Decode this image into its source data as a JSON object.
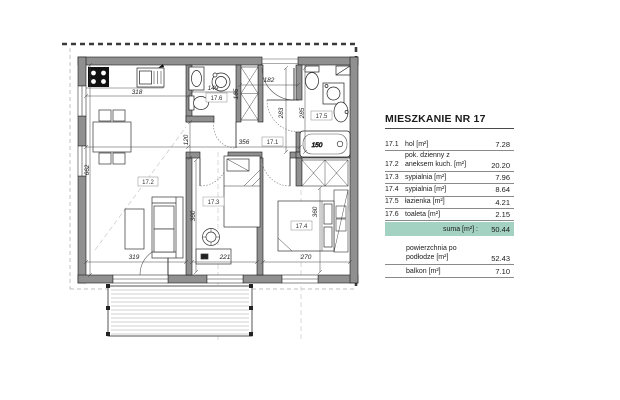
{
  "title": "MIESZKANIE NR 17",
  "area_table": {
    "rows": [
      {
        "code": "17.1",
        "name": "hol [m²]",
        "value": "7.28"
      },
      {
        "code": "17.2",
        "name": "pok. dzienny z aneksem kuch. [m²]",
        "value": "20.20"
      },
      {
        "code": "17.3",
        "name": "sypialnia [m²]",
        "value": "7.96"
      },
      {
        "code": "17.4",
        "name": "sypialnia [m²]",
        "value": "8.64"
      },
      {
        "code": "17.5",
        "name": "łazienka [m²]",
        "value": "4.21"
      },
      {
        "code": "17.6",
        "name": "toaleta [m²]",
        "value": "2.15"
      }
    ],
    "sum_label": "suma [m²] :",
    "sum_value": "50.44",
    "extra_rows": [
      {
        "name": "powierzchnia po podłodze [m²]",
        "value": "52.43"
      },
      {
        "name": "balkon [m²]",
        "value": "7.10"
      }
    ]
  },
  "plan": {
    "rooms": {
      "r1": "17.1",
      "r2": "17.2",
      "r3": "17.3",
      "r4": "17.4",
      "r5": "17.5",
      "r6": "17.6"
    },
    "dims": {
      "d318": "318",
      "d662": "662",
      "d319": "319",
      "d149": "149",
      "d165": "165",
      "d120": "120",
      "d356": "356",
      "d182": "182",
      "d283": "283",
      "d285": "285",
      "d360a": "360",
      "d360b": "360",
      "d221": "221",
      "d270": "270",
      "d150": "150"
    },
    "watermark": {
      "l1": "c",
      "l2": "u"
    }
  },
  "colors": {
    "accent_teal": "#a3d2c2",
    "wall_gray": "#909090",
    "dashed_boundary": "#3a3a3a"
  }
}
